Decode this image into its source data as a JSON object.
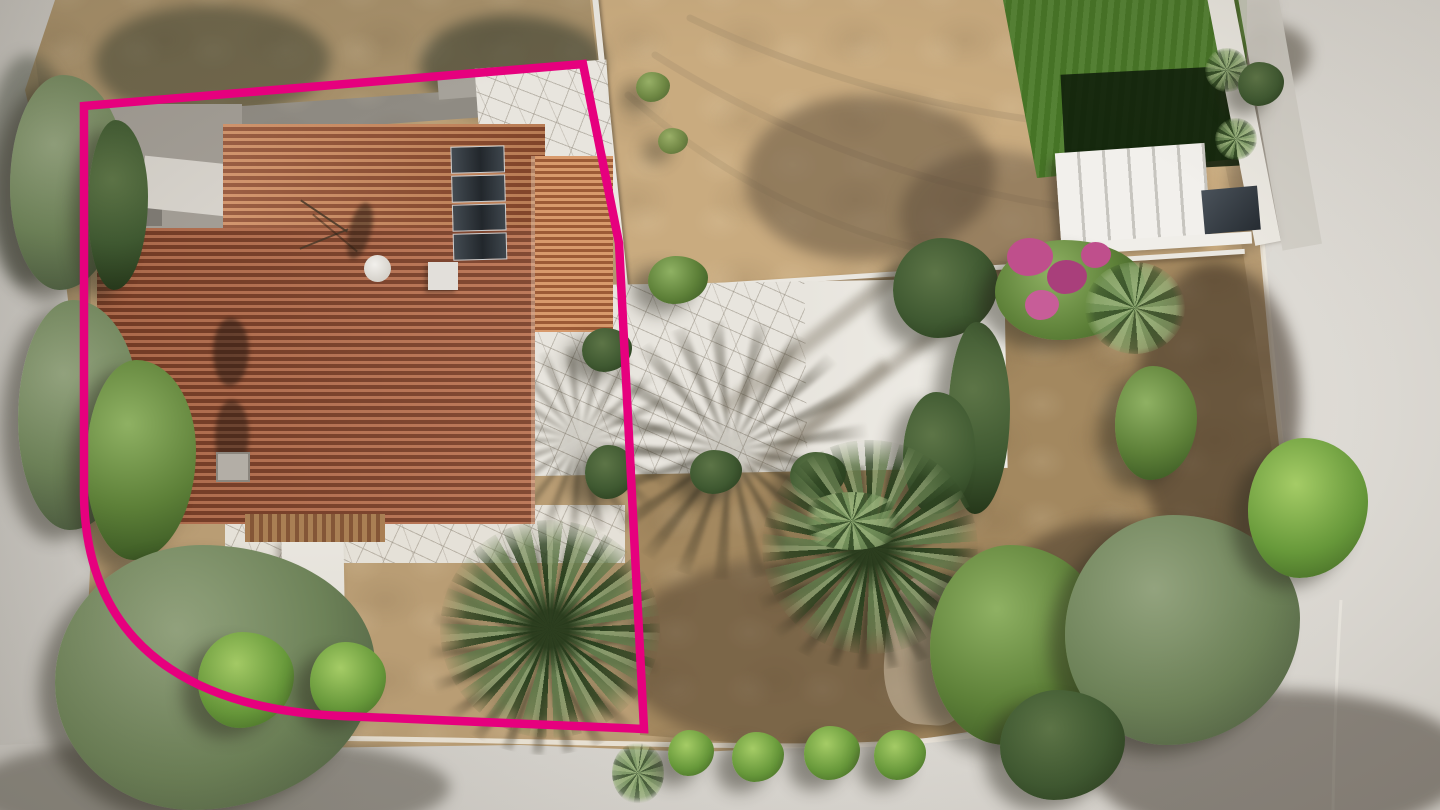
{
  "scene": {
    "type": "aerial-photograph",
    "description": "Top-down drone photo of a corner plot: a terracotta tile-roof house with rooftop solar panels outlined by a thick magenta property boundary with a rounded street corner, flagstone patio, dry garden with two large palms and bougainvillea, neighbouring artificial lawn with white pergola at top right, bare sandy lot at top, and pale concrete roads along the left, bottom and right edges"
  },
  "boundary": {
    "color": "#e6007e",
    "stroke_width": 8.5,
    "corner_style": "rounded bottom-left street corner",
    "path": "M 84 106 L 583 64 L 619 243 L 644 729 L 342 716 C 226 711 87 669 84 496 Z"
  },
  "ground_markings": {
    "kerb_path": "M 1243 2 C 1254 150 1268 320 1282 450 C 1290 545 1266 612 1208 662 C 1146 712 1036 732 898 743 C 760 752 520 737 140 737",
    "kerb_inner_path": "M 1333 810 C 1334 740 1336 680 1341 600",
    "patio_edge_path": "M 638 470 L 838 468",
    "tracks": [
      "M 690 18 C 850 95 1020 128 1185 132",
      "M 655 55 C 820 160 990 205 1160 218",
      "M 628 95 C 760 210 900 262 1080 272"
    ]
  },
  "palette": {
    "boundary": "#e6007e",
    "sand_base": "#b99d74",
    "sand_lot": "#c9ab7f",
    "dirt": "#a8916b",
    "soil": "#a3885f",
    "soil_dark": "#55432f",
    "road": "#c8c5bf",
    "road_light": "#d9d6d0",
    "kerb": "#ece7dc",
    "patio": "#e8e5de",
    "white_wall": "#eae7e0",
    "pergola_slat": "#c7c5bf",
    "lawn": "#4a7a28",
    "lawn_shadow": "#0f1e0a",
    "roof_hi_a": "#cd8a5e",
    "roof_lo_a": "#8f4c2e",
    "roof_hi_b": "#b97251",
    "roof_lo_b": "#7b3f27",
    "roof_hi_c": "#d89a6c",
    "roof_lo_c": "#9c5a36",
    "panel": "#2b3136",
    "deck_hi": "#a97f54",
    "deck_lo": "#845637",
    "flower": "#bf4f8c",
    "flower_green": "#6a8f3f",
    "olive_hi": "#93a37e",
    "olive_mid": "#6d8258",
    "olive_lo": "#46553b",
    "green_hi": "#8fb163",
    "green_mid": "#5d8038",
    "green_lo": "#33501f",
    "dark_hi": "#5d7547",
    "dark_mid": "#3f5931",
    "dark_lo": "#233418",
    "bright_hi": "#a5cc66",
    "bright_mid": "#67993a",
    "bright_lo": "#3b5e20",
    "palm_a": "#60784a",
    "palm_b": "#2c4220",
    "palm_c": "#86996b"
  },
  "features": {
    "house": {
      "roof": "terracotta tile roof",
      "solar_panel_count": 4,
      "satellite_dish": true,
      "chimneys": 2,
      "wood_deck": true,
      "entrance_terrace": true
    },
    "vegetation": {
      "large_palms": 2,
      "roadside_bushes": 4,
      "bougainvillea": true,
      "yucca": true,
      "agave": true,
      "olive_trees": true,
      "cypress_group": true
    },
    "structures": {
      "artificial_lawn": true,
      "pergola": true,
      "white_perimeter_walls": true,
      "flagstone_patio": true,
      "garden_path_with_gate": true
    },
    "roads": [
      "left",
      "bottom",
      "right"
    ]
  }
}
